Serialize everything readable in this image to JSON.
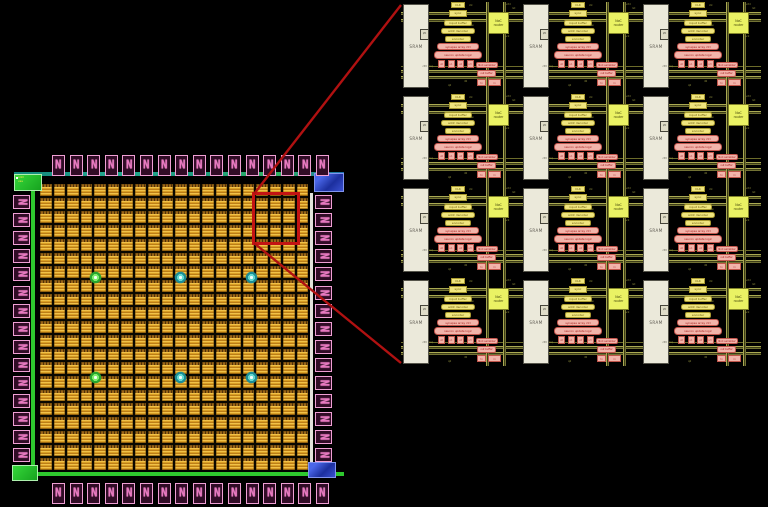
{
  "colors": {
    "background": "#000000",
    "pad_pink": "#ef9fd4",
    "core_orange": "#d99e24",
    "seal_green": "#2ec82e",
    "seal_teal": "#1b9a7f",
    "corner_blue": "#2b46cc",
    "highlight_red": "#c31313",
    "sram_white": "#ebe9da",
    "logic_yellow": "#f0e57e",
    "datapath_pink": "#f2b4aa",
    "router_yellow": "#eaf264",
    "bus_olive": "#7c7c34"
  },
  "die": {
    "pad_glyph": "N",
    "pad_counts": {
      "top": 16,
      "bottom": 16,
      "left": 15,
      "right": 15
    },
    "core_grid": {
      "cols": 20,
      "rows": 21
    },
    "corner_label_lines": [
      "vdd",
      "vss"
    ],
    "markers": [
      {
        "type": "green",
        "x": 89,
        "y": 129
      },
      {
        "type": "teal",
        "x": 174,
        "y": 129
      },
      {
        "type": "teal",
        "x": 245,
        "y": 129
      },
      {
        "type": "green",
        "x": 89,
        "y": 229
      },
      {
        "type": "teal",
        "x": 174,
        "y": 229
      },
      {
        "type": "teal",
        "x": 245,
        "y": 229
      }
    ]
  },
  "zoom_panel": {
    "grid": {
      "cols": 3,
      "rows": 4
    },
    "tile": {
      "sram_label": "SRAM",
      "io_label": "I/O",
      "sram_port_label": "ctrl",
      "stack": [
        "CLK",
        "sync",
        "input buffer",
        "addr decoder",
        "encoder"
      ],
      "pink_bars": [
        "synapse array ctrl",
        "neuron update logic"
      ],
      "unit_squares": [
        "u0",
        "u1",
        "u2",
        "u3"
      ],
      "router_line1": "NoC",
      "router_line2": "router",
      "noc_bars": [
        "NoC serializer",
        "out buffer"
      ],
      "noc_squares": [
        "tx",
        "rx"
      ],
      "tick_labels": [
        "clk",
        "vdd",
        "rst",
        "en",
        "ack",
        "req",
        "d0",
        "q0"
      ]
    }
  }
}
